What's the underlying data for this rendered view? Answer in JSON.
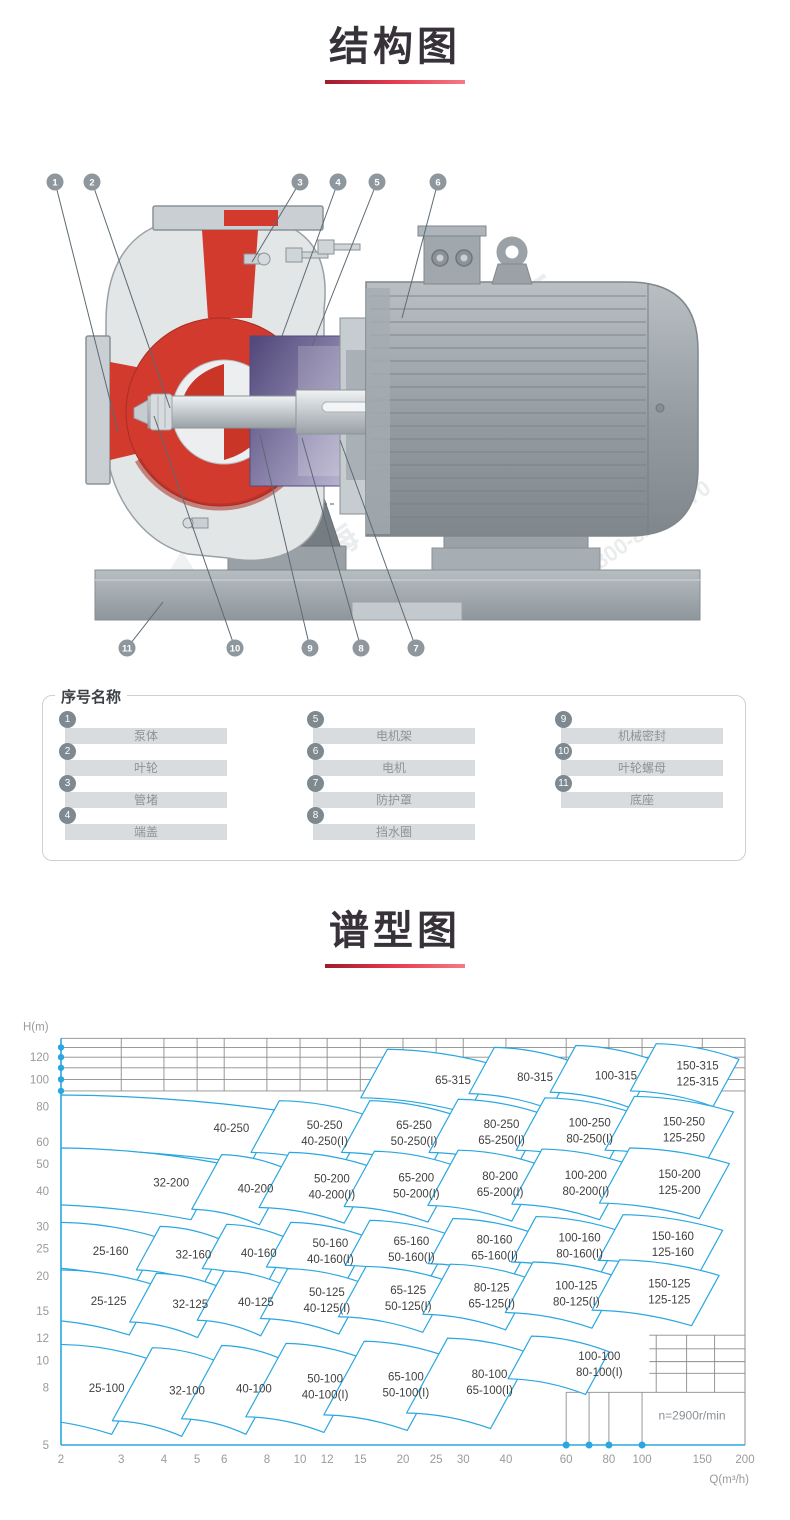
{
  "structure_section": {
    "title": "结构图"
  },
  "spectrum_section": {
    "title": "谱型图"
  },
  "watermark": {
    "brand": "上海东海",
    "phone": "800-820-6570"
  },
  "legend": {
    "title": "序号名称",
    "items": [
      {
        "num": "1",
        "label": "泵体"
      },
      {
        "num": "2",
        "label": "叶轮"
      },
      {
        "num": "3",
        "label": "管堵"
      },
      {
        "num": "4",
        "label": "端盖"
      },
      {
        "num": "5",
        "label": "电机架"
      },
      {
        "num": "6",
        "label": "电机"
      },
      {
        "num": "7",
        "label": "防护罩"
      },
      {
        "num": "8",
        "label": "挡水圈"
      },
      {
        "num": "9",
        "label": "机械密封"
      },
      {
        "num": "10",
        "label": "叶轮螺母"
      },
      {
        "num": "11",
        "label": "底座"
      }
    ]
  },
  "callouts": [
    {
      "num": "1",
      "cx": 55,
      "cy": 32,
      "tx": 118,
      "ty": 282
    },
    {
      "num": "2",
      "cx": 92,
      "cy": 32,
      "tx": 170,
      "ty": 258
    },
    {
      "num": "3",
      "cx": 300,
      "cy": 32,
      "tx": 252,
      "ty": 112
    },
    {
      "num": "4",
      "cx": 338,
      "cy": 32,
      "tx": 282,
      "ty": 186
    },
    {
      "num": "5",
      "cx": 377,
      "cy": 32,
      "tx": 312,
      "ty": 196
    },
    {
      "num": "6",
      "cx": 438,
      "cy": 32,
      "tx": 402,
      "ty": 168
    },
    {
      "num": "7",
      "cx": 416,
      "cy": 498,
      "tx": 340,
      "ty": 290
    },
    {
      "num": "8",
      "cx": 361,
      "cy": 498,
      "tx": 302,
      "ty": 288
    },
    {
      "num": "9",
      "cx": 310,
      "cy": 498,
      "tx": 260,
      "ty": 285
    },
    {
      "num": "10",
      "cx": 235,
      "cy": 498,
      "tx": 154,
      "ty": 266
    },
    {
      "num": "11",
      "cx": 127,
      "cy": 498,
      "tx": 163,
      "ty": 452
    }
  ],
  "colors": {
    "accent_red": "#c9253a",
    "curve_blue": "#2aa7e0",
    "grid_gray": "#8c8c8c",
    "label_gray": "#3f3f3f",
    "tick_gray": "#9a9a9a",
    "callout_gray": "#8e979d"
  },
  "chart_data": {
    "type": "area",
    "title": "谱型图",
    "note": "n=2900r/min",
    "note_pos": {
      "q": 140,
      "h": 6.15
    },
    "x_axis": {
      "label": "Q(m³/h)",
      "scale": "log",
      "range": [
        2,
        200
      ],
      "ticks": [
        2,
        3,
        4,
        5,
        6,
        8,
        10,
        12,
        15,
        20,
        25,
        30,
        40,
        60,
        80,
        100,
        150,
        200
      ]
    },
    "y_axis": {
      "label": "H(m)",
      "scale": "log",
      "range": [
        5,
        140
      ],
      "ticks": [
        5,
        8,
        10,
        12,
        15,
        20,
        25,
        30,
        40,
        50,
        60,
        80,
        100,
        120
      ]
    },
    "grid": {
      "top_h": [
        140,
        130,
        120,
        110,
        100,
        91
      ],
      "axis_dots_h": [
        130,
        120,
        110,
        100,
        91
      ],
      "axis_dots_q": [
        60,
        70,
        80,
        100
      ],
      "mesh": {
        "h_lines": [
          {
            "h": 7.7,
            "q1": 60,
            "q2": 200
          },
          {
            "h": 9.0,
            "q1": 105,
            "q2": 200
          },
          {
            "h": 9.9,
            "q1": 105,
            "q2": 200
          },
          {
            "h": 11.0,
            "q1": 105,
            "q2": 200
          },
          {
            "h": 12.3,
            "q1": 105,
            "q2": 200
          }
        ],
        "v_lines": [
          {
            "q": 60,
            "h1": 5,
            "h2": 7.7
          },
          {
            "q": 70,
            "h1": 5,
            "h2": 7.7
          },
          {
            "q": 80,
            "h1": 5,
            "h2": 7.7
          },
          {
            "q": 100,
            "h1": 5,
            "h2": 7.7
          },
          {
            "q": 110,
            "h1": 7.7,
            "h2": 12.3
          },
          {
            "q": 135,
            "h1": 7.7,
            "h2": 12.3
          },
          {
            "q": 163,
            "h1": 7.7,
            "h2": 12.3
          }
        ]
      }
    },
    "regions": [
      {
        "labels": [
          "65-315"
        ],
        "q1": 18,
        "q2": 37,
        "ht": 128,
        "hb": 86,
        "lq": 28
      },
      {
        "labels": [
          "80-315"
        ],
        "q1": 37,
        "q2": 64,
        "ht": 130,
        "hb": 89
      },
      {
        "labels": [
          "100-315"
        ],
        "q1": 64,
        "q2": 110,
        "ht": 132,
        "hb": 90
      },
      {
        "labels": [
          "150-315",
          "125-315"
        ],
        "q1": 110,
        "q2": 192,
        "ht": 134,
        "hb": 91
      },
      {
        "labels": [
          "40-250"
        ],
        "q1": 2,
        "q2": 8.7,
        "ht": 88,
        "hb": 57,
        "lq": 6.3
      },
      {
        "labels": [
          "50-250",
          "40-250(I)"
        ],
        "q1": 8.7,
        "q2": 16,
        "ht": 84,
        "hb": 55
      },
      {
        "labels": [
          "65-250",
          "50-250(I)"
        ],
        "q1": 16,
        "q2": 29,
        "ht": 84,
        "hb": 55
      },
      {
        "labels": [
          "80-250",
          "65-250(I)"
        ],
        "q1": 29,
        "q2": 52,
        "ht": 85,
        "hb": 55
      },
      {
        "labels": [
          "100-250",
          "80-250(I)"
        ],
        "q1": 52,
        "q2": 95,
        "ht": 86,
        "hb": 56
      },
      {
        "labels": [
          "150-250",
          "125-250"
        ],
        "q1": 95,
        "q2": 185,
        "ht": 87,
        "hb": 56
      },
      {
        "labels": [
          "32-200"
        ],
        "q1": 2,
        "q2": 5.9,
        "ht": 57,
        "hb": 36,
        "lq": 4.2
      },
      {
        "labels": [
          "40-200"
        ],
        "q1": 5.9,
        "q2": 9.3,
        "ht": 54,
        "hb": 34.5
      },
      {
        "labels": [
          "50-200",
          "40-200(I)"
        ],
        "q1": 9.3,
        "q2": 16.5,
        "ht": 55,
        "hb": 35
      },
      {
        "labels": [
          "65-200",
          "50-200(I)"
        ],
        "q1": 16.5,
        "q2": 29,
        "ht": 55.5,
        "hb": 35.3
      },
      {
        "labels": [
          "80-200",
          "65-200(I)"
        ],
        "q1": 29,
        "q2": 51,
        "ht": 56,
        "hb": 35.6
      },
      {
        "labels": [
          "100-200",
          "80-200(I)"
        ],
        "q1": 51,
        "q2": 92,
        "ht": 56.5,
        "hb": 36
      },
      {
        "labels": [
          "150-200",
          "125-200"
        ],
        "q1": 92,
        "q2": 180,
        "ht": 57,
        "hb": 36.3
      },
      {
        "labels": [
          "25-160"
        ],
        "q1": 2,
        "q2": 3.9,
        "ht": 31,
        "hb": 21.5
      },
      {
        "labels": [
          "32-160"
        ],
        "q1": 3.9,
        "q2": 6.1,
        "ht": 30,
        "hb": 21
      },
      {
        "labels": [
          "40-160"
        ],
        "q1": 6.1,
        "q2": 9.4,
        "ht": 30.5,
        "hb": 21.2
      },
      {
        "labels": [
          "50-160",
          "40-160(I)"
        ],
        "q1": 9.4,
        "q2": 16,
        "ht": 31,
        "hb": 21.5
      },
      {
        "labels": [
          "65-160",
          "50-160(I)"
        ],
        "q1": 16,
        "q2": 28,
        "ht": 31.5,
        "hb": 21.8
      },
      {
        "labels": [
          "80-160",
          "65-160(I)"
        ],
        "q1": 28,
        "q2": 49,
        "ht": 32,
        "hb": 22.1
      },
      {
        "labels": [
          "100-160",
          "80-160(I)"
        ],
        "q1": 49,
        "q2": 88,
        "ht": 32.5,
        "hb": 22.4
      },
      {
        "labels": [
          "150-160",
          "125-160"
        ],
        "q1": 88,
        "q2": 172,
        "ht": 33,
        "hb": 22.7
      },
      {
        "labels": [
          "25-125"
        ],
        "q1": 2,
        "q2": 3.8,
        "ht": 21,
        "hb": 14
      },
      {
        "labels": [
          "32-125"
        ],
        "q1": 3.8,
        "q2": 6.0,
        "ht": 20.4,
        "hb": 13.7
      },
      {
        "labels": [
          "40-125"
        ],
        "q1": 6.0,
        "q2": 9.2,
        "ht": 20.8,
        "hb": 13.9
      },
      {
        "labels": [
          "50-125",
          "40-125(I)"
        ],
        "q1": 9.2,
        "q2": 15.6,
        "ht": 21.2,
        "hb": 14.1
      },
      {
        "labels": [
          "65-125",
          "50-125(I)"
        ],
        "q1": 15.6,
        "q2": 27.5,
        "ht": 21.6,
        "hb": 14.3
      },
      {
        "labels": [
          "80-125",
          "65-125(I)"
        ],
        "q1": 27.5,
        "q2": 48,
        "ht": 22,
        "hb": 14.6
      },
      {
        "labels": [
          "100-125",
          "80-125(I)"
        ],
        "q1": 48,
        "q2": 86,
        "ht": 22.4,
        "hb": 14.8
      },
      {
        "labels": [
          "150-125",
          "125-125"
        ],
        "q1": 86,
        "q2": 168,
        "ht": 22.8,
        "hb": 15.1
      },
      {
        "labels": [
          "25-100"
        ],
        "q1": 2,
        "q2": 3.7,
        "ht": 11.4,
        "hb": 6.2
      },
      {
        "labels": [
          "32-100"
        ],
        "q1": 3.7,
        "q2": 5.9,
        "ht": 11.1,
        "hb": 6.1
      },
      {
        "labels": [
          "40-100"
        ],
        "q1": 5.9,
        "q2": 9.1,
        "ht": 11.3,
        "hb": 6.2
      },
      {
        "labels": [
          "50-100",
          "40-100(I)"
        ],
        "q1": 9.1,
        "q2": 15.4,
        "ht": 11.5,
        "hb": 6.3
      },
      {
        "labels": [
          "65-100",
          "50-100(I)"
        ],
        "q1": 15.4,
        "q2": 27,
        "ht": 11.7,
        "hb": 6.4
      },
      {
        "labels": [
          "80-100",
          "65-100(I)"
        ],
        "q1": 27,
        "q2": 47.5,
        "ht": 12,
        "hb": 6.5
      },
      {
        "labels": [
          "100-100",
          "80-100(I)"
        ],
        "q1": 47.5,
        "q2": 80,
        "ht": 12.2,
        "hb": 8.6,
        "lq": 75
      }
    ]
  }
}
